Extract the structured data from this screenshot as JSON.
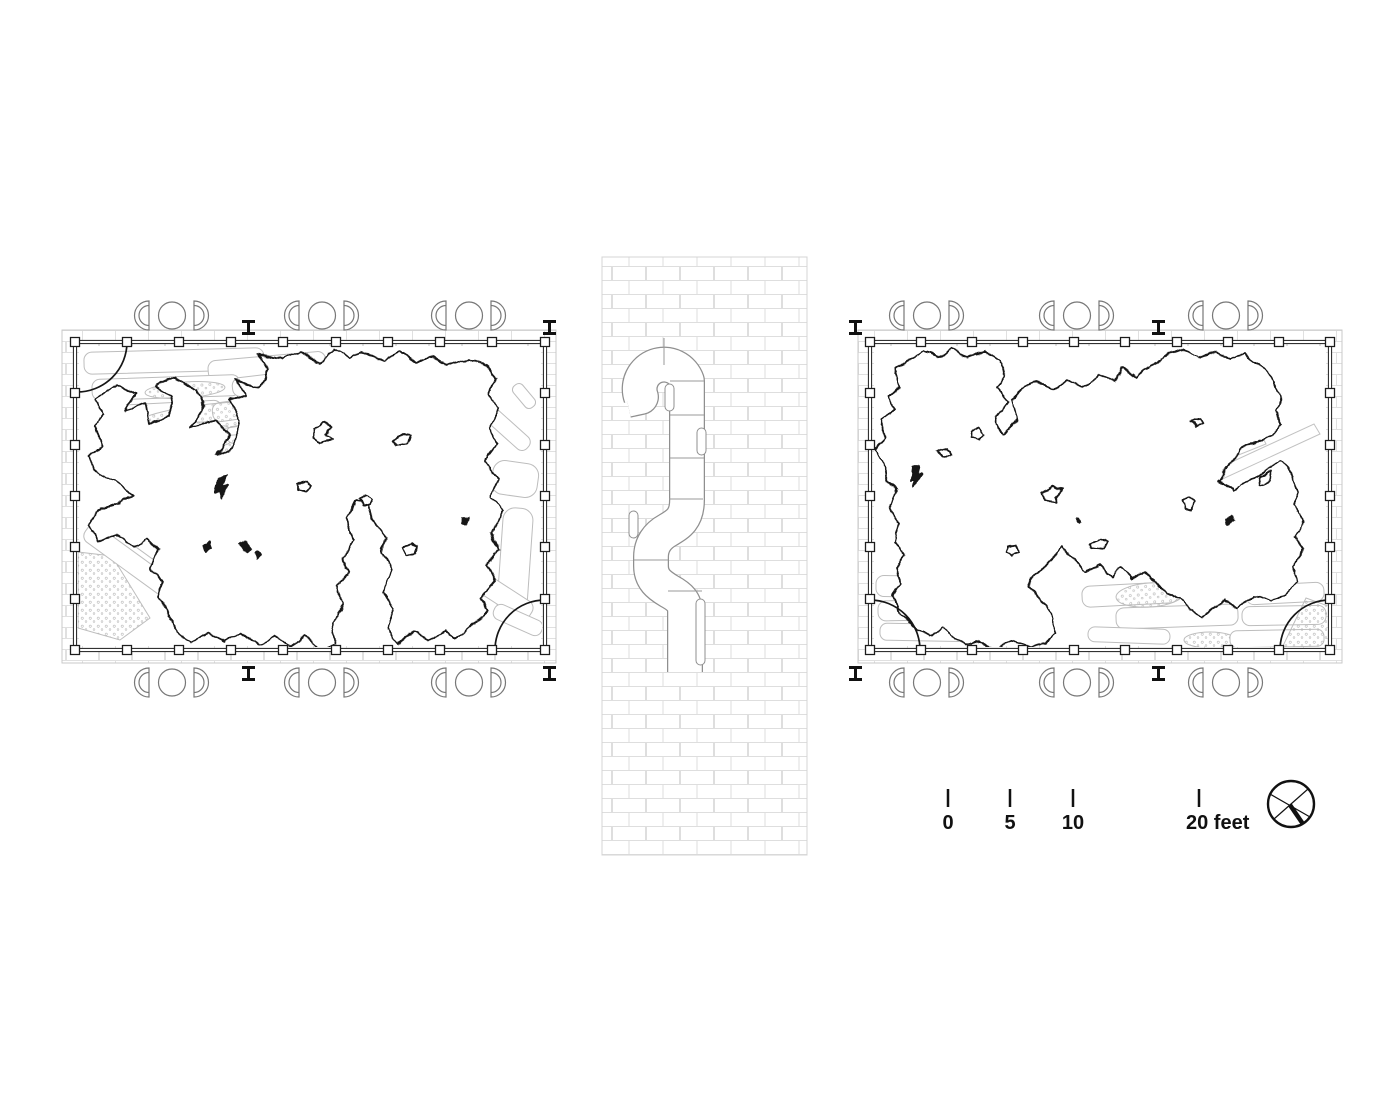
{
  "drawing": {
    "kind": "architectural floor plan pair with wall section",
    "sheet_background": "#ffffff"
  },
  "scale_bar": {
    "labels": [
      "0",
      "5",
      "10",
      "20 feet"
    ]
  },
  "compass": {
    "icon": "north-arrow-icon"
  },
  "plans": {
    "left": {
      "seating_groups_top": 3,
      "seating_groups_bottom": 3,
      "steel_beam_markers": 4,
      "door_swings": [
        "top-left",
        "bottom-right"
      ]
    },
    "right": {
      "seating_groups_top": 3,
      "seating_groups_bottom": 3,
      "steel_beam_markers": 4,
      "door_swings": [
        "bottom-left",
        "bottom-right"
      ]
    }
  },
  "wall_section": {
    "joint_pills": 4
  },
  "colors": {
    "ink": "#161616",
    "light_gray_line": "#bdbdbd",
    "brick_line": "#dedede",
    "section_line": "#8f8f8f"
  }
}
